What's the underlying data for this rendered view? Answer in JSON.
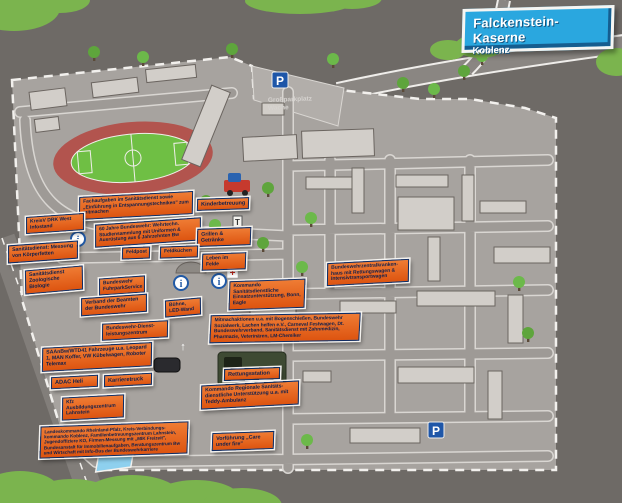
{
  "banner": {
    "title": "Falckenstein-Kaserne",
    "subtitle": "Koblenz"
  },
  "map": {
    "parking_label": {
      "line1": "Großparkplatz",
      "line2": "Wache"
    },
    "icons": {
      "parking_letter": "P",
      "info_letter": "i",
      "sign_letter": "T",
      "arrow_up": "↑",
      "red_cross": "+"
    }
  },
  "colors": {
    "label_orange": "#e8611a",
    "label_border_blue": "#0f2b63",
    "banner_blue": "#2aa7df",
    "map_gray": "#a7a39f",
    "outside_gray": "#6e6a66",
    "field_green": "#6fbf44",
    "track_red": "#b2544e",
    "bush_green": "#7bb44e",
    "parking_sign_blue": "#1e56a8"
  },
  "labels": [
    {
      "id": "fachaufgaben",
      "text": "Fachaufgaben im Sanitätsdienst sowie „Einführung in Entspannungstechniken\" zum mitmachen"
    },
    {
      "id": "jahre-60-bw",
      "text": "60 Jahre Bundeswehr: Wehrtechn. Studiensammlung mit Uniformen & Ausrüstung aus 6 Jahrzehnten Bw"
    },
    {
      "id": "drk-infostand",
      "text": "KreisV DRK West Infostand"
    },
    {
      "id": "san-messung",
      "text": "Sanitätsdienst: Messung von Körperfetten"
    },
    {
      "id": "san-biologie",
      "text": "Sanitätsdienst Zoologische Biologie"
    },
    {
      "id": "fuhrparkservice",
      "text": "Bundeswehr FuhrparkService"
    },
    {
      "id": "verband-beamten",
      "text": "Verband der Beamten der Bundeswehr"
    },
    {
      "id": "bw-dlz",
      "text": "Bundeswehr-Dienst­leistungszentrum"
    },
    {
      "id": "buehne",
      "text": "Bühne, LED-Wand"
    },
    {
      "id": "saanbw-wtd41",
      "text": "SAAnBw/WTD41 Fahrzeuge u.a. Leopard 1, MAN Koffer, VW Kübel­wagen, Roboter Telemax"
    },
    {
      "id": "adac-heli",
      "text": "ADAC Heli"
    },
    {
      "id": "karrieretruck",
      "text": "Karrieretruck"
    },
    {
      "id": "kfz-ausbildung",
      "text": "Kfz Ausbildungszentrum Lahnstein"
    },
    {
      "id": "landeskommando",
      "text": "Landeskommando Rheinland-Pfalz, Kreis-Verbindungs­kommando Koblenz, Familienbetreuungszentrum Lahnstein, Jugendoffiziere KO, Firmen-Messung mit „MIK Freizeit\", Bundesanstalt für Immobilienaufgaben, Beratungszentrum Bw und Wirtschaft mit Info-Bus der Bundeswehrkarriere"
    },
    {
      "id": "kinderbetreuung",
      "text": "Kinderbetreuung"
    },
    {
      "id": "grillen",
      "text": "Grillen & Getränke"
    },
    {
      "id": "feldpost",
      "text": "Feldpost"
    },
    {
      "id": "feldkuechen",
      "text": "Feldküchen"
    },
    {
      "id": "leben-im-felde",
      "text": "Leben im Felde"
    },
    {
      "id": "kdo-san-einsatz",
      "text": "Kommando Sanitätsdienstliche Einsatzunterstützung, Bonn, Eagle"
    },
    {
      "id": "mitmachaktionen",
      "text": "Mitmachaktionen u.a. mit Bogenschießen, Bundeswehr Sozialwerk, Lachen helfen e.V., Carneval Festwagen, Dt. Bundeswehrverband, Sanitätsdienst mit Zahnmedizin, Pharmazie, Veterinären, LM-Chemiker"
    },
    {
      "id": "bw-zentralkrankenhaus",
      "text": "Bundeswehrzentralkranken­haus mit Rettungswagen & Intensivtransportwagen"
    },
    {
      "id": "rettungsstation",
      "text": "Rettungsstation"
    },
    {
      "id": "kdo-reg-san",
      "text": "Kommando Regionale Sanitäts­dienstliche Unterstützung u.a. mit Teddy-Ambulanz"
    },
    {
      "id": "vorfuehrung",
      "text": "Vorführung „Care under fire\""
    }
  ]
}
